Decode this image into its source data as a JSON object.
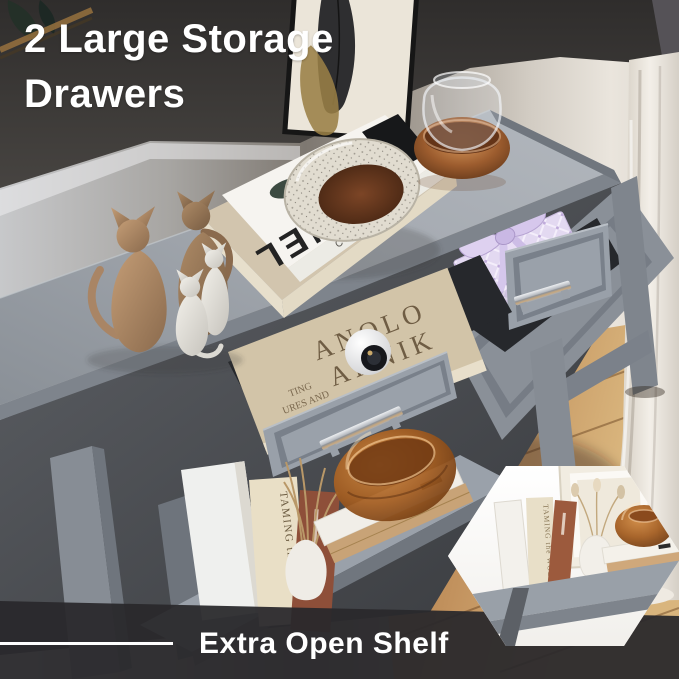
{
  "header": {
    "title_line1": "2 Large Storage",
    "title_line2": "Drawers"
  },
  "footer": {
    "caption": "Extra Open Shelf"
  },
  "decor_text": {
    "chanel_cover": "CHANEL",
    "chanel_edge": "CHANEL",
    "drawer_book": {
      "word1": "ANOLO",
      "word2": "AHNIK",
      "small1": "TING",
      "small2": "URES AND",
      "small3": "SESSIONS"
    },
    "shelf_book_spine": "TAMING the WOLF",
    "inset_book_spine": "TAMING the WOLF"
  },
  "colors": {
    "table_gray": "#9aa0a8",
    "wall_dark": "#3b3937",
    "floor_wood": "#bd8e58",
    "curtain": "#ece7df",
    "gift_lavender": "#dcd0ea",
    "amber_glass": "#a9611f",
    "band_dark": "#2a292d",
    "text_white": "#ffffff"
  }
}
